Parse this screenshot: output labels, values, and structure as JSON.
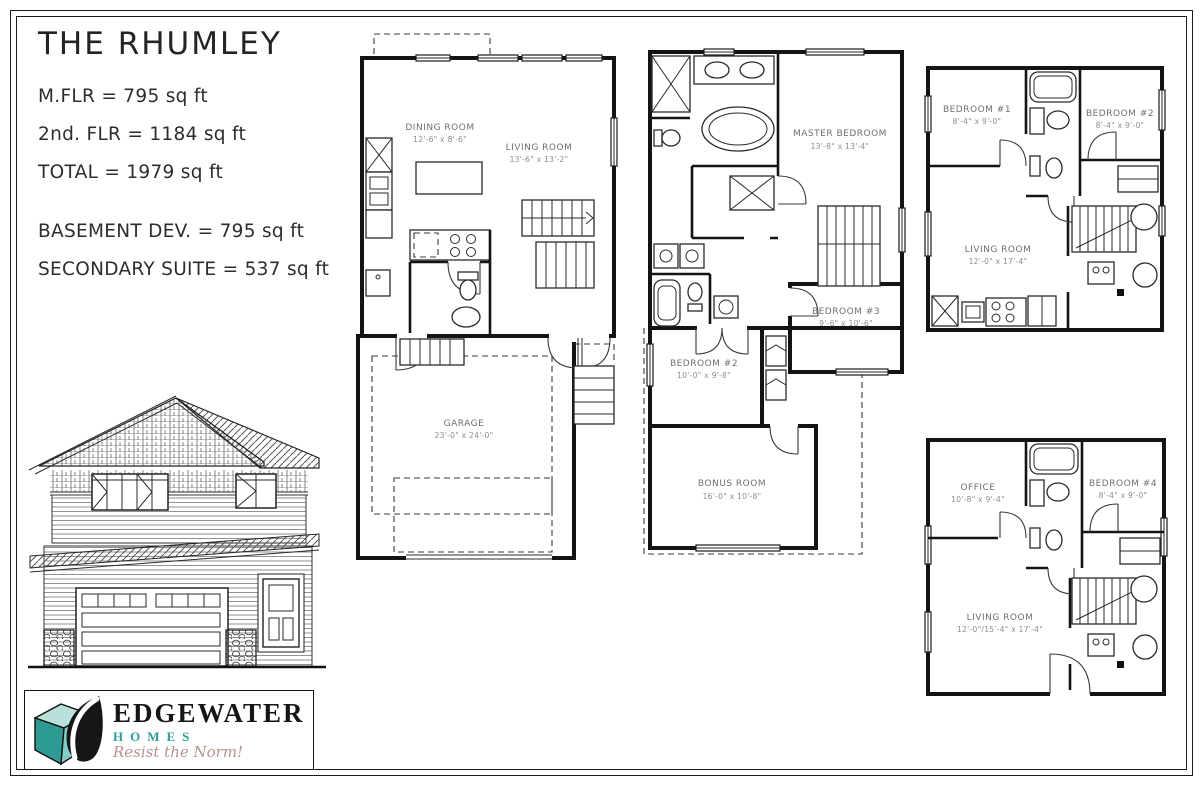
{
  "header": {
    "plan_name": "THE RHUMLEY",
    "area_lines": [
      "M.FLR = 795 sq ft",
      "2nd. FLR = 1184 sq ft",
      "TOTAL = 1979 sq ft"
    ],
    "basement_lines": [
      "BASEMENT DEV. = 795 sq ft",
      "SECONDARY SUITE = 537 sq ft"
    ]
  },
  "plans": {
    "main_floor": {
      "dining_room": {
        "name": "DINING ROOM",
        "dims": "12'-6\" x 8'-6\""
      },
      "living_room": {
        "name": "LIVING ROOM",
        "dims": "13'-6\" x 13'-2\""
      },
      "garage": {
        "name": "GARAGE",
        "dims": "23'-0\" x 24'-0\""
      }
    },
    "second_floor": {
      "master_bedroom": {
        "name": "MASTER BEDROOM",
        "dims": "13'-8\" x 13'-4\""
      },
      "bedroom_3": {
        "name": "BEDROOM #3",
        "dims": "9'-6\" x 10'-6\""
      },
      "bedroom_2": {
        "name": "BEDROOM #2",
        "dims": "10'-0\" x 9'-8\""
      },
      "bonus_room": {
        "name": "BONUS ROOM",
        "dims": "16'-0\" x 10'-8\""
      }
    },
    "basement_suite": {
      "bedroom_1": {
        "name": "BEDROOM #1",
        "dims": "8'-4\" x 9'-0\""
      },
      "bedroom_2": {
        "name": "BEDROOM #2",
        "dims": "8'-4\" x 9'-0\""
      },
      "living_room": {
        "name": "LIVING ROOM",
        "dims": "12'-0\" x 17'-4\""
      }
    },
    "basement_dev": {
      "office": {
        "name": "OFFICE",
        "dims": "10'-8\" x 9'-4\""
      },
      "bedroom_4": {
        "name": "BEDROOM #4",
        "dims": "8'-4\" x 9'-0\""
      },
      "living_room": {
        "name": "LIVING ROOM",
        "dims": "12'-0\"/15'-4\" x 17'-4\""
      }
    }
  },
  "logo": {
    "brand": "EDGEWATER",
    "word": "HOMES",
    "tagline": "Resist the Norm!",
    "colors": {
      "teal": "#2f9e97",
      "teal_light": "#b9e1dc",
      "teal_mid": "#82cdc6",
      "ink": "#161616",
      "tagline_color": "#b5928e"
    }
  }
}
